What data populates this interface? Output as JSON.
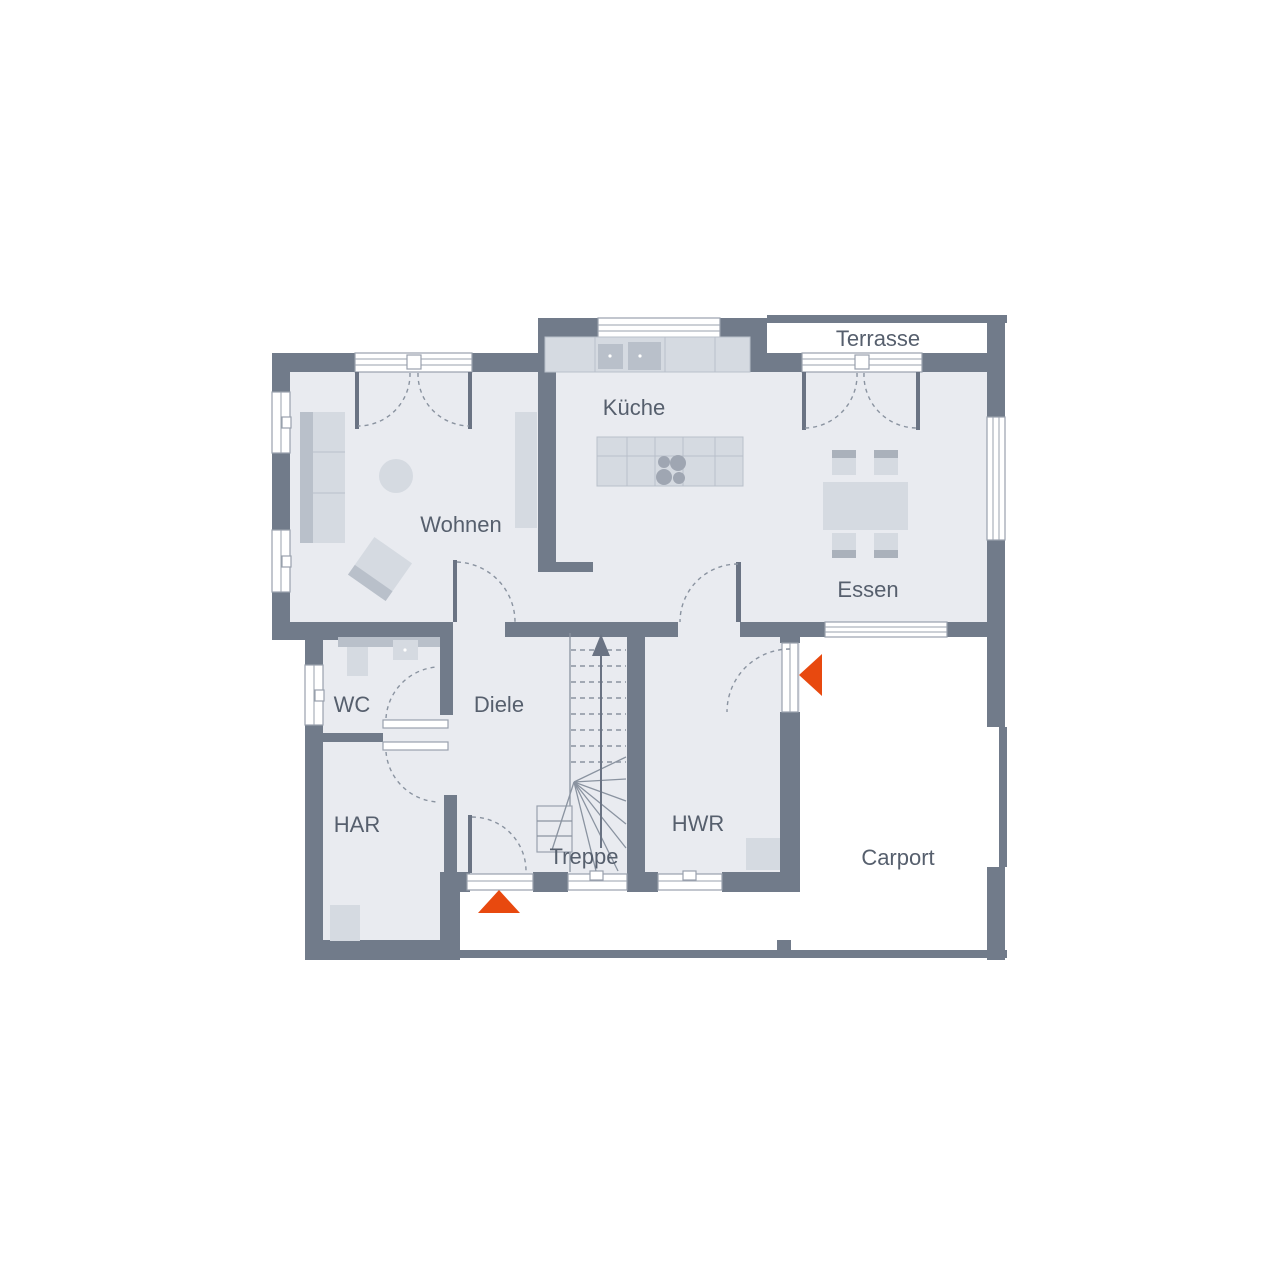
{
  "plan": {
    "title": "Erdgeschoss Grundriss",
    "rooms": {
      "terrasse": {
        "label": "Terrasse"
      },
      "kueche": {
        "label": "Küche"
      },
      "wohnen": {
        "label": "Wohnen"
      },
      "essen": {
        "label": "Essen"
      },
      "wc": {
        "label": "WC"
      },
      "diele": {
        "label": "Diele"
      },
      "har": {
        "label": "HAR"
      },
      "hwr": {
        "label": "HWR"
      },
      "treppe": {
        "label": "Treppe"
      },
      "carport": {
        "label": "Carport"
      }
    },
    "markers": {
      "front_entrance": {
        "name": "entrance-arrow-front",
        "direction": "up"
      },
      "side_entrance": {
        "name": "entrance-arrow-side",
        "direction": "left"
      }
    },
    "colors": {
      "wall": "#717b8a",
      "floor": "#e9ebf0",
      "furniture_light": "#d5dae1",
      "furniture_mid": "#b9c0ca",
      "furniture_dark": "#9fa6b2",
      "outline": "#99a1ad",
      "label_text": "#565f6d",
      "accent_orange": "#e8490f",
      "outdoor": "#ffffff"
    }
  }
}
